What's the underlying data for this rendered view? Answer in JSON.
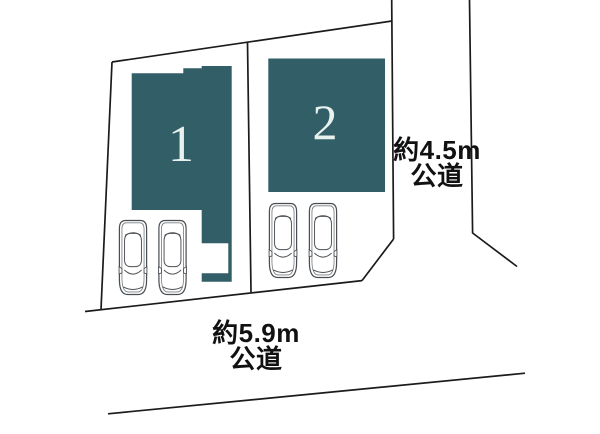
{
  "plot_layout": {
    "lots": [
      {
        "number": "1",
        "parked_cars": 2
      },
      {
        "number": "2",
        "parked_cars": 2
      }
    ],
    "roads": {
      "right": {
        "width": "約4.5m",
        "type": "公道"
      },
      "bottom": {
        "width": "約5.9m",
        "type": "公道"
      }
    },
    "colors": {
      "building_fill": "#315E67",
      "boundary_line": "#1B1B1B",
      "lot_number_text": "#E9F1EF",
      "road_label_text": "#111111"
    },
    "icons": {
      "car": "car-top-view-icon"
    }
  }
}
